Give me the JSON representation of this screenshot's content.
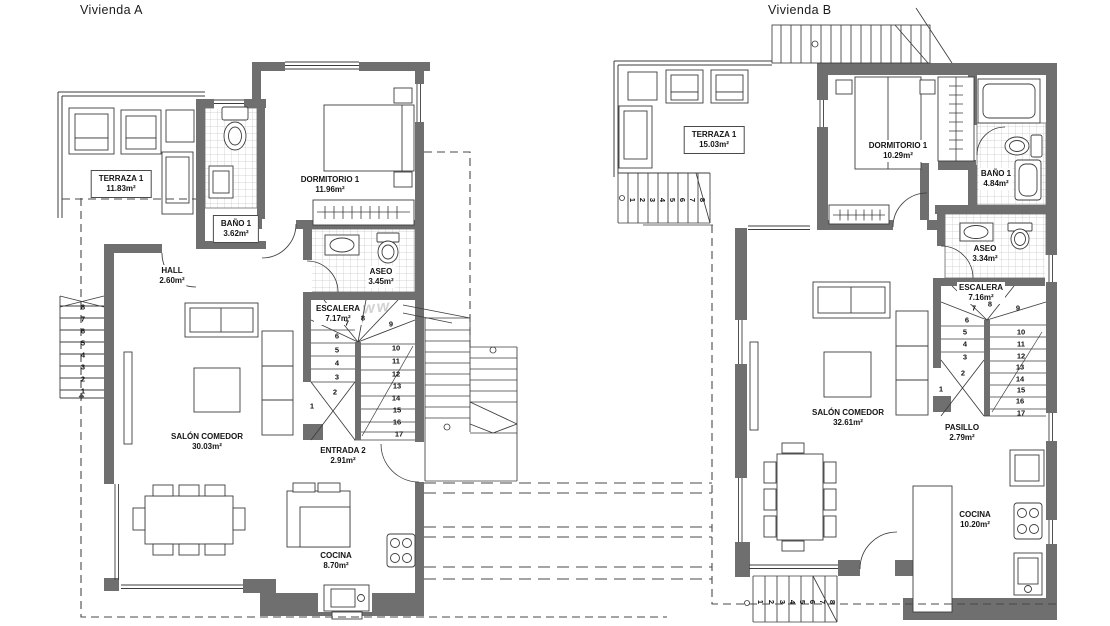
{
  "watermark": "www",
  "plan_a": {
    "title": "Vivienda A",
    "rooms": {
      "terraza": {
        "name": "TERRAZA 1",
        "area": "11.83m²"
      },
      "bano": {
        "name": "BAÑO 1",
        "area": "3.62m²"
      },
      "dormitorio": {
        "name": "DORMITORIO 1",
        "area": "11.96m²"
      },
      "hall": {
        "name": "HALL",
        "area": "2.60m²"
      },
      "aseo": {
        "name": "ASEO",
        "area": "3.45m²"
      },
      "escalera": {
        "name": "ESCALERA",
        "area": "7.17m²"
      },
      "salon": {
        "name": "SALÓN COMEDOR",
        "area": "30.03m²"
      },
      "entrada": {
        "name": "ENTRADA 2",
        "area": "2.91m²"
      },
      "cocina": {
        "name": "COCINA",
        "area": "8.70m²"
      }
    },
    "stairs": {
      "exterior": [
        "1",
        "2",
        "3",
        "4",
        "5",
        "6",
        "7",
        "8"
      ],
      "interior": [
        "1",
        "2",
        "3",
        "4",
        "5",
        "6",
        "7",
        "8",
        "9",
        "10",
        "11",
        "12",
        "13",
        "14",
        "15",
        "16",
        "17"
      ]
    }
  },
  "plan_b": {
    "title": "Vivienda B",
    "rooms": {
      "terraza": {
        "name": "TERRAZA 1",
        "area": "15.03m²"
      },
      "dormitorio": {
        "name": "DORMITORIO 1",
        "area": "10.29m²"
      },
      "bano": {
        "name": "BAÑO 1",
        "area": "4.84m²"
      },
      "aseo": {
        "name": "ASEO",
        "area": "3.34m²"
      },
      "escalera": {
        "name": "ESCALERA",
        "area": "7.16m²"
      },
      "salon": {
        "name": "SALÓN COMEDOR",
        "area": "32.61m²"
      },
      "pasillo": {
        "name": "PASILLO",
        "area": "2.79m²"
      },
      "cocina": {
        "name": "COCINA",
        "area": "10.20m²"
      }
    },
    "stairs": {
      "terraza": [
        "1",
        "2",
        "3",
        "4",
        "5",
        "6",
        "7",
        "8"
      ],
      "interior": [
        "1",
        "2",
        "3",
        "4",
        "5",
        "6",
        "7",
        "8",
        "9",
        "10",
        "11",
        "12",
        "13",
        "14",
        "15",
        "16",
        "17"
      ],
      "acceso": [
        "1",
        "2",
        "3",
        "4",
        "5",
        "6",
        "7",
        "8"
      ]
    }
  }
}
